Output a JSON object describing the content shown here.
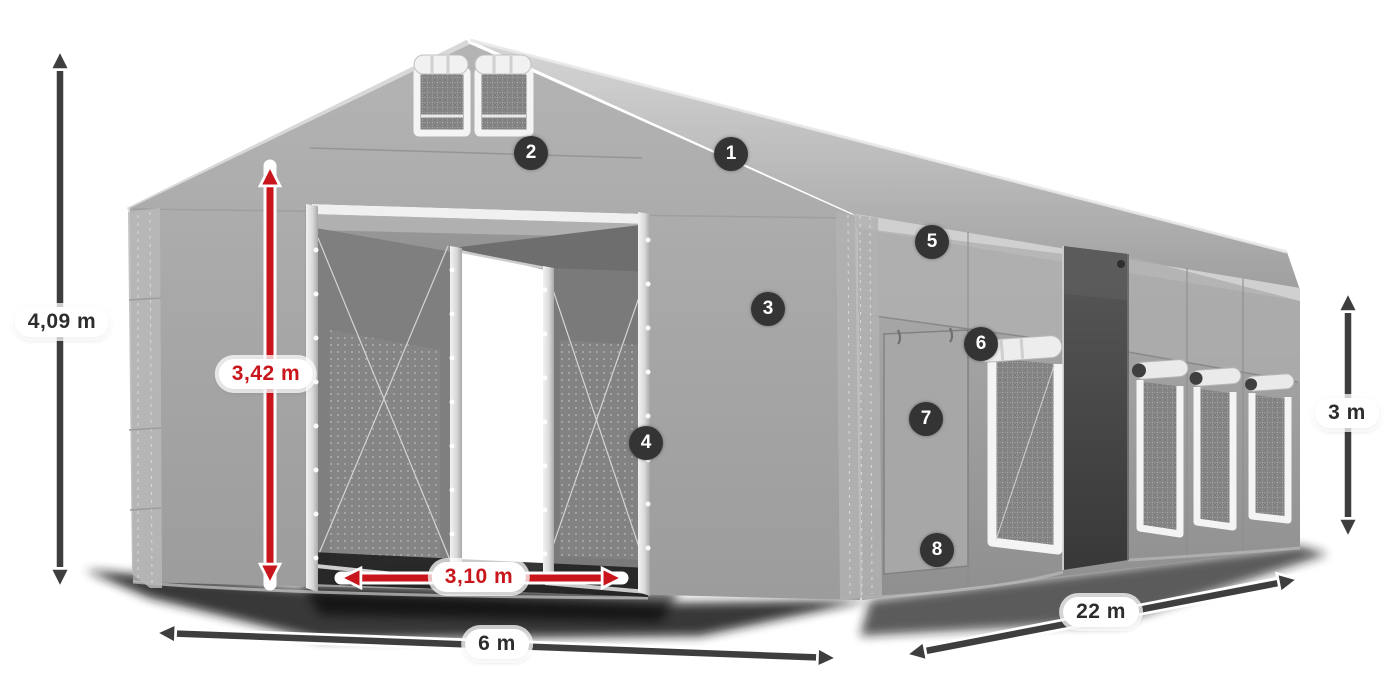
{
  "illustration": {
    "subject": "grey-marquee-tent-3d-diagram"
  },
  "dimension_labels": {
    "total_height": {
      "text": "4,09 m",
      "color_style": "dark"
    },
    "entrance_height": {
      "text": "3,42 m",
      "color_style": "red"
    },
    "entrance_width": {
      "text": "3,10 m",
      "color_style": "red"
    },
    "gable_width": {
      "text": "6 m",
      "color_style": "dark"
    },
    "length": {
      "text": "22 m",
      "color_style": "dark"
    },
    "side_height": {
      "text": "3 m",
      "color_style": "dark"
    }
  },
  "feature_markers": [
    {
      "number": "1"
    },
    {
      "number": "2"
    },
    {
      "number": "3"
    },
    {
      "number": "4"
    },
    {
      "number": "5"
    },
    {
      "number": "6"
    },
    {
      "number": "7"
    },
    {
      "number": "8"
    }
  ],
  "colors": {
    "dimension_red": "#c9161c",
    "dimension_dark": "#3e3e3e",
    "marker_background": "#343434",
    "marker_text": "#ffffff",
    "label_background": "#ffffff",
    "label_text": "#2d2d2d",
    "tent_light": "#d2d2d2",
    "tent_mid": "#a5a5a5",
    "tent_dark": "#6f6f6f",
    "opening_dark": "#424242"
  }
}
